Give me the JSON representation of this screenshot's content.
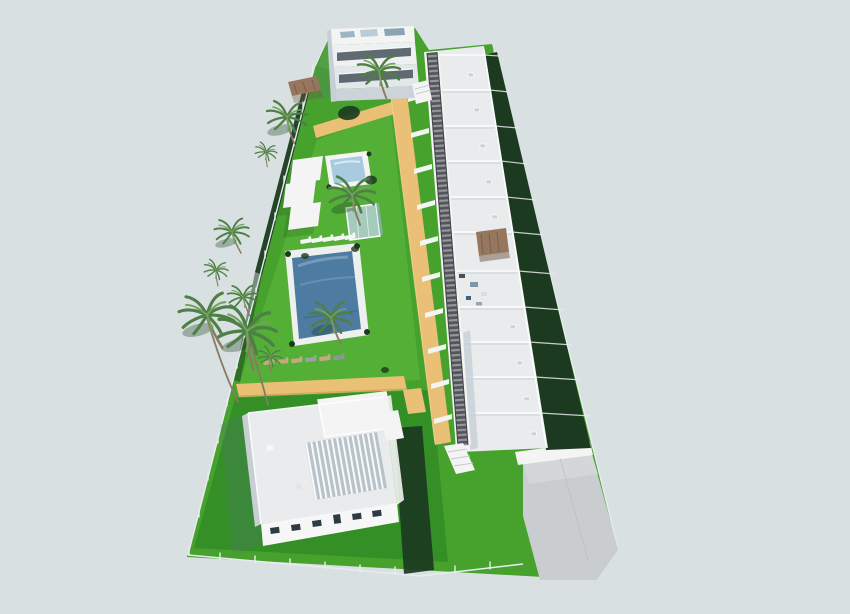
{
  "scene": {
    "type": "3d-architectural-render",
    "description": "Aerial 3D rendering of a new-build residential development: a diagonal row of white flat-roofed townhouses with roof terraces and dark hedge back gardens, a dark pergola walkway, a communal garden with two swimming pools, white shade sails, sun loungers and palm trees, an apartment block at the top, a large villa with a slatted roof pergola at the bottom, a grey paved entrance court, all on a pale blue-grey backdrop",
    "background": "plain pale blue-grey studio sky",
    "counts": {
      "townhouse_units": 11,
      "swimming_pools": 2,
      "glass_pavilions": 1,
      "shade_sails": 3,
      "sun_loungers_white": 5,
      "sun_loungers_tan": 6,
      "palm_trees": 11,
      "roof_terrace_pergolas": 1
    },
    "features": [
      "communal lawn garden",
      "main swimming pool",
      "kids pool",
      "glass pavilion",
      "orange sand-coloured footpaths",
      "dark pergola walkway with stairs to each unit",
      "perimeter glass fence",
      "villa with slatted roof pergola",
      "paved entrance court"
    ]
  },
  "palette": {
    "background": "#d9e0e2",
    "lawn": "#46a22d",
    "lawn_light": "#57b238",
    "lawn_dark": "#2f8824",
    "hedge_dark": "#1b3a1f",
    "path_orange": "#eabf76",
    "path_shade": "#c9974e",
    "path_highlight": "#f2d28f",
    "white_building": "#f3f4f3",
    "roof_light": "#e9ebed",
    "wall_shade": "#c7cfd5",
    "pergola_dark": "#54555a",
    "pergola_slat": "#c9cdd1",
    "pool_main": "#4e7ba2",
    "pool_small": "#a8cbe0",
    "glass_blue": "#b9d2e0",
    "paving_gray": "#c9cdcf",
    "palm_green": "#4e7f45",
    "palm_light": "#72a35c",
    "trunk_brown": "#8a7a64",
    "lounger_tan": "#c2a97e",
    "shadow_blue": "#5a7285",
    "fence_light": "#e8edef",
    "glazing_dark": "#46525c",
    "brown_pergola": "#96765c"
  }
}
